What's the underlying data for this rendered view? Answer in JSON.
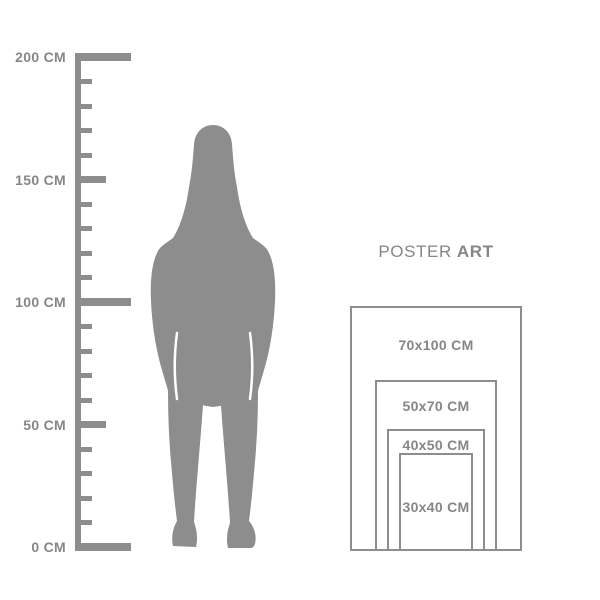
{
  "colors": {
    "shape": "#8d8d8d",
    "border": "#8d8d8d",
    "text": "#868686",
    "background": "#ffffff"
  },
  "ruler": {
    "min_cm": 0,
    "max_cm": 200,
    "step_cm": 10,
    "px_per_cm": 2.45,
    "baseline_y": 547,
    "labels": [
      {
        "cm": 200,
        "text": "200 CM"
      },
      {
        "cm": 150,
        "text": "150 CM"
      },
      {
        "cm": 100,
        "text": "100 CM"
      },
      {
        "cm": 50,
        "text": "50 CM"
      },
      {
        "cm": 0,
        "text": "0 CM"
      }
    ]
  },
  "size_guide": {
    "title": {
      "regular": "POSTER",
      "bold": "ART"
    },
    "anchor": {
      "center_x": 436,
      "bottom_y": 551
    },
    "sizes": [
      {
        "label": "70x100 CM",
        "width_cm": 70,
        "height_cm": 100,
        "label_y": 345
      },
      {
        "label": "50x70 CM",
        "width_cm": 50,
        "height_cm": 70,
        "label_y": 406
      },
      {
        "label": "40x50 CM",
        "width_cm": 40,
        "height_cm": 50,
        "label_y": 445
      },
      {
        "label": "30x40 CM",
        "width_cm": 30,
        "height_cm": 40,
        "label_y": 507
      }
    ]
  }
}
